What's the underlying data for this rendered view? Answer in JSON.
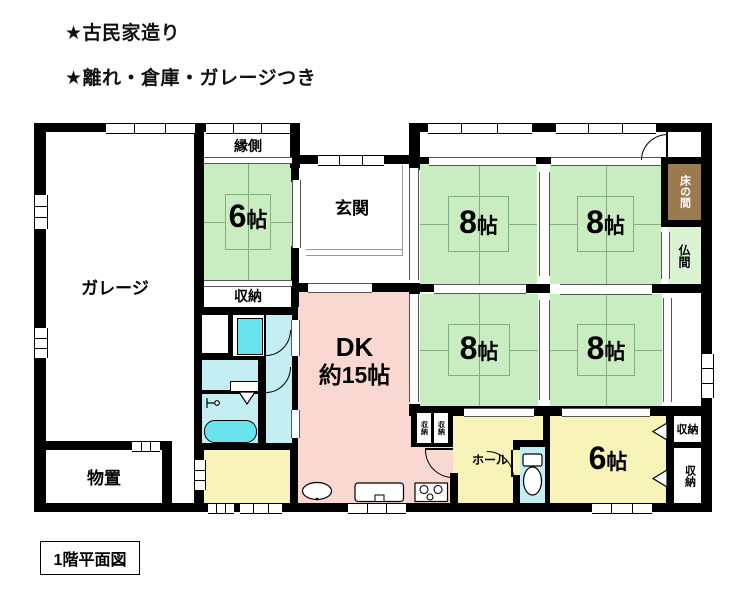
{
  "header": {
    "line1": "★古民家造り",
    "line2": "★離れ・倉庫・ガレージつき"
  },
  "footer": {
    "label": "1階平面図"
  },
  "rooms": {
    "garage": {
      "label": "ガレージ"
    },
    "engawa": {
      "label": "縁側"
    },
    "tatami6_top": {
      "num": "6",
      "unit": "帖"
    },
    "closet_mid": {
      "label": "収納"
    },
    "genkan": {
      "label": "玄関"
    },
    "t8_tl": {
      "num": "8",
      "unit": "帖"
    },
    "t8_tr": {
      "num": "8",
      "unit": "帖"
    },
    "t8_bl": {
      "num": "8",
      "unit": "帖"
    },
    "t8_br": {
      "num": "8",
      "unit": "帖"
    },
    "tokonoma": {
      "label": "床の間"
    },
    "butsuma": {
      "label": "仏間"
    },
    "dk": {
      "line1": "DK",
      "line2": "約15帖"
    },
    "monooki": {
      "label": "物置"
    },
    "hall": {
      "label": "ホール"
    },
    "tatami6_bottom": {
      "num": "6",
      "unit": "帖"
    },
    "closet_east_top": {
      "label": "収納"
    },
    "closet_east_bottom": {
      "label": "収納"
    },
    "closet_wall_left": {
      "label": "収納"
    },
    "closet_wall_right": {
      "label": "収納"
    }
  },
  "colors": {
    "tatami_green": "#c9edc1",
    "pale_green": "#daf3d3",
    "yellow": "#f7f3b9",
    "pink": "#f9d8d2",
    "cyan_pale": "#c5eef3",
    "cyan_bright": "#69e4ee",
    "brown": "#9a7a50",
    "wall": "#000000"
  }
}
